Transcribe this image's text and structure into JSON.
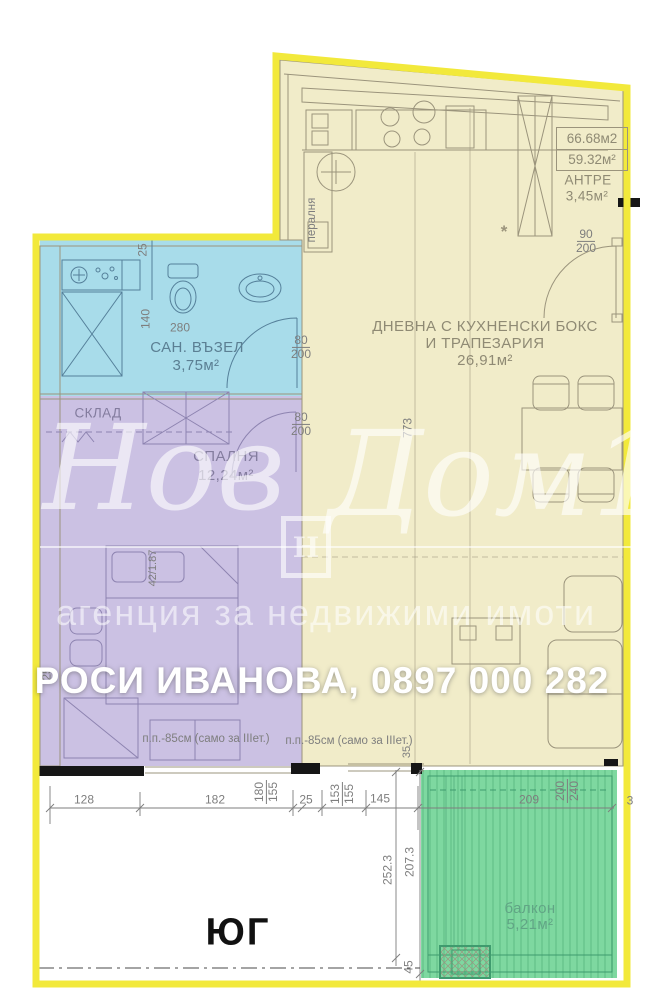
{
  "title": "Апартамент - план етаж",
  "colors": {
    "border": "#f2e93b",
    "living": "#f1ecc9",
    "bath": "#a8dcea",
    "bedroom": "#cbc1e3",
    "balcony": "#7ed8a0",
    "wall": "#161616",
    "line_living": "#9b947c",
    "line_bath": "#55809a",
    "line_bedroom": "#8d83b0",
    "line_balcony": "#3f9b6e",
    "dim_text": "#7e7e7e",
    "room_living": "#8f8a74",
    "room_bath": "#5b7f93",
    "room_bedroom": "#837c9e",
    "room_balcony": "#61a585",
    "banner": "#ffffff",
    "watermark": "rgba(255,255,255,0.62)"
  },
  "areas_box": {
    "line1": "66.68м2",
    "line2": "59.32м²"
  },
  "rooms": {
    "antre": {
      "name": "АНТРЕ",
      "area": "3,45м²"
    },
    "living": {
      "name_line1": "ДНЕВНА С КУХНЕНСКИ БОКС",
      "name_line2": "И ТРАПЕЗАРИЯ",
      "area": "26,91м²"
    },
    "bath": {
      "name": "САН. ВЪЗЕЛ",
      "area": "3,75м²"
    },
    "bedroom": {
      "name": "СПАЛНЯ",
      "area": "12,24м²"
    },
    "storage": {
      "name": "СКЛАД"
    },
    "balcony": {
      "name": "балкон",
      "area": "5,21м²"
    }
  },
  "orientation_label": "ЮГ",
  "agent_banner": "РОСИ ИВАНОВА, 0897 000 282",
  "watermark": {
    "word1": "Нов",
    "word2": "Дом1",
    "logo_letter": "Н",
    "tagline": "агенция за недвижими имоти"
  },
  "annotations": [
    {
      "t": "25",
      "x": 143,
      "y": 250,
      "rot": -90
    },
    {
      "t": "140",
      "x": 146,
      "y": 319,
      "rot": -90
    },
    {
      "t": "280",
      "x": 180,
      "y": 328
    },
    {
      "t": "пералня",
      "x": 312,
      "y": 220,
      "rot": -90,
      "cls": "note"
    },
    {
      "t": "*",
      "x": 504,
      "y": 232,
      "cls": "star"
    },
    {
      "num": "90",
      "den": "200",
      "x": 586,
      "y": 241
    },
    {
      "num": "80",
      "den": "200",
      "x": 301,
      "y": 347
    },
    {
      "num": "80",
      "den": "200",
      "x": 301,
      "y": 424
    },
    {
      "t": "773",
      "x": 408,
      "y": 428,
      "rot": -90
    },
    {
      "t": "42/1.87",
      "x": 154,
      "y": 568,
      "rot": -90,
      "cls": "dim-sm"
    },
    {
      "t": "25",
      "x": 47,
      "y": 674,
      "rot": -90
    },
    {
      "t": "п.п.-85см (само за IIIет.)",
      "x": 206,
      "y": 739,
      "cls": "note"
    },
    {
      "t": "п.п.-85см (само за IIIет.)",
      "x": 349,
      "y": 741,
      "cls": "note"
    },
    {
      "t": "35",
      "x": 408,
      "y": 752,
      "rot": -90,
      "cls": "dim-sm"
    },
    {
      "t": "128",
      "x": 84,
      "y": 800
    },
    {
      "t": "182",
      "x": 215,
      "y": 800
    },
    {
      "num": "180",
      "den": "155",
      "x": 266,
      "y": 792,
      "rot": -90
    },
    {
      "t": "25",
      "x": 306,
      "y": 800
    },
    {
      "num": "153",
      "den": "155",
      "x": 342,
      "y": 794,
      "rot": -90
    },
    {
      "t": "145",
      "x": 380,
      "y": 799
    },
    {
      "t": "209",
      "x": 529,
      "y": 800
    },
    {
      "num": "200",
      "den": "240",
      "x": 567,
      "y": 791,
      "rot": -90
    },
    {
      "t": "3",
      "x": 630,
      "y": 801
    },
    {
      "t": "252.3",
      "x": 388,
      "y": 870,
      "rot": -90
    },
    {
      "t": "207.3",
      "x": 410,
      "y": 862,
      "rot": -90
    },
    {
      "t": "45",
      "x": 409,
      "y": 967,
      "rot": -90
    }
  ]
}
